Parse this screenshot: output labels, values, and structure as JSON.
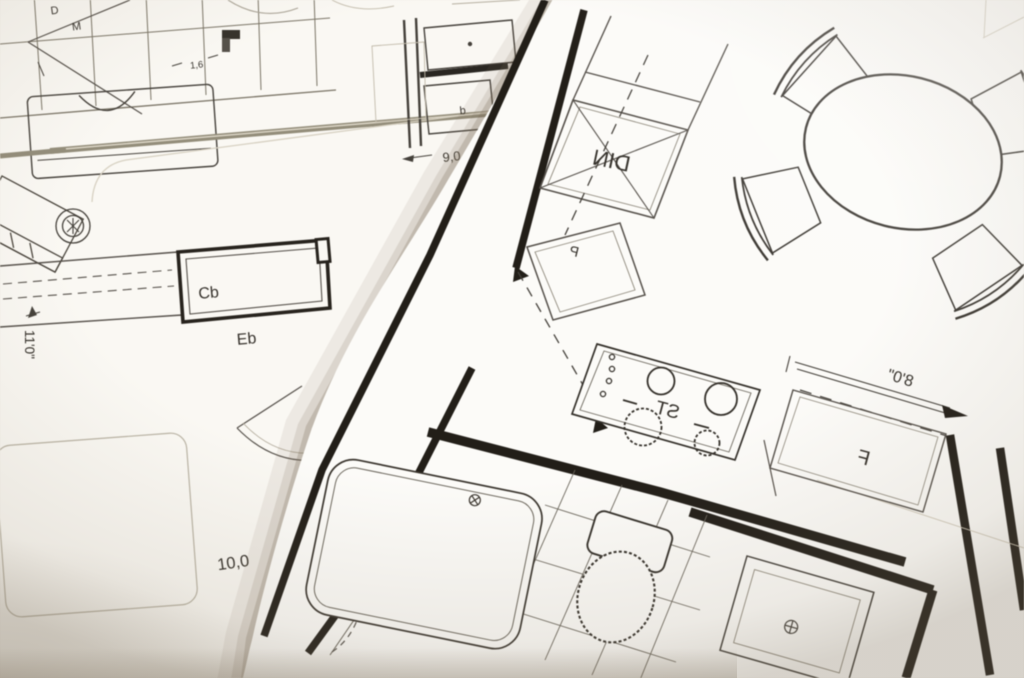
{
  "top_plan": {
    "mirrored": true,
    "labels": {
      "dining": "DIN",
      "pantry": "P",
      "stove": "ST",
      "fridge": "F"
    },
    "dimensions": {
      "fridge_width": "8'0\""
    }
  },
  "bottom_plan": {
    "mirrored": false,
    "labels": {
      "closet_1": "Cb",
      "closet_2": "Eb",
      "mark_d": "D",
      "mark_m": "M",
      "cabinet_mark": "b"
    },
    "dimensions": {
      "side_height": "11'0\"",
      "room_width": "10,0",
      "front_width": "9,0",
      "small_gap": "1,6"
    }
  },
  "colors": {
    "paper_bottom": "#faf8f3",
    "paper_top": "#fcfbf8",
    "ink_dark": "#27231d",
    "ink_mid": "#4a453d",
    "ink_faint": "#c2bbab",
    "beam": "#938d7a",
    "shadow": "#7d7058"
  }
}
